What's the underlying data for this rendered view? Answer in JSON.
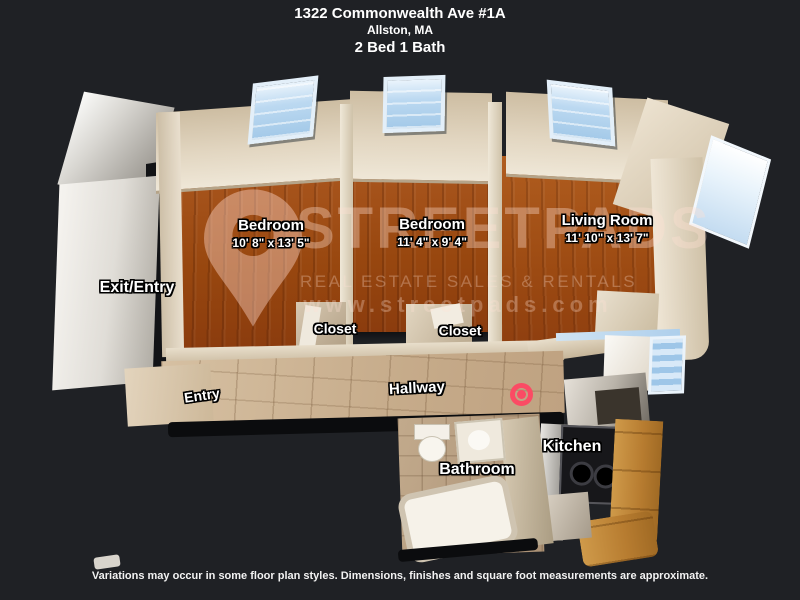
{
  "header": {
    "address": "1322 Commonwealth Ave #1A",
    "city": "Allston, MA",
    "beds_baths": "2 Bed 1 Bath"
  },
  "rooms": {
    "bedroom1": {
      "name": "Bedroom",
      "dims": "10' 8\" x 13' 5\""
    },
    "bedroom2": {
      "name": "Bedroom",
      "dims": "11' 4\" x 9' 4\""
    },
    "living": {
      "name": "Living Room",
      "dims": "11' 10\" x 13' 7\""
    },
    "exit_entry": {
      "label": "Exit/Entry"
    },
    "closet_left": {
      "label": "Closet"
    },
    "closet_right": {
      "label": "Closet"
    },
    "entry": {
      "label": "Entry"
    },
    "hallway": {
      "label": "Hallway"
    },
    "kitchen": {
      "label": "Kitchen"
    },
    "bathroom": {
      "label": "Bathroom"
    }
  },
  "watermark": {
    "brand": "STREETPADS",
    "tagline": "REAL ESTATE SALES & RENTALS",
    "website": "www.streetpads.com"
  },
  "footer": {
    "disclaimer": "Variations may occur in some floor plan styles. Dimensions, finishes and square foot measurements are approximate."
  },
  "marker": {
    "color": "#fb4b64"
  },
  "colors": {
    "background": "#1f2125",
    "wood_floor": "#9c4f1d",
    "tile_floor": "#c9b193",
    "wall": "#ddd0ba",
    "window_glass": "#bcd9f1"
  }
}
